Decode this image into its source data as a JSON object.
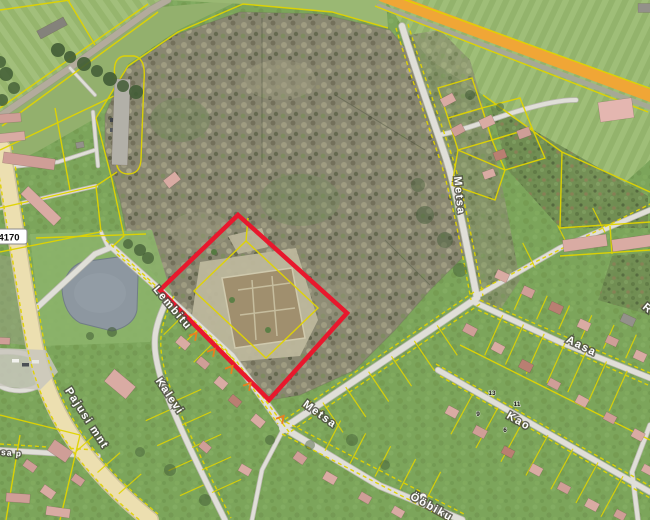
{
  "map": {
    "description": "Aerial cadastral map with selected parcel highlighted",
    "selected_parcel": {
      "outline_color": "#e8182d"
    },
    "cadastral": {
      "line_color": "#e0d400",
      "road_number": "4170"
    },
    "streets": {
      "pajusi_mnt": "Pajusi mnt",
      "lembitu": "Lembitu",
      "kalevi": "Kalevi",
      "metsa_north": "Metsa",
      "metsa_south": "Metsa",
      "aasa": "Aasa",
      "kao": "Kao",
      "oobiku": "Ööbiku",
      "kesa_partial": "Kesa p",
      "edge_fragment": "R"
    },
    "parcel_numbers": {
      "n13": "13",
      "n11": "11",
      "n9": "9",
      "n6": "6"
    }
  }
}
